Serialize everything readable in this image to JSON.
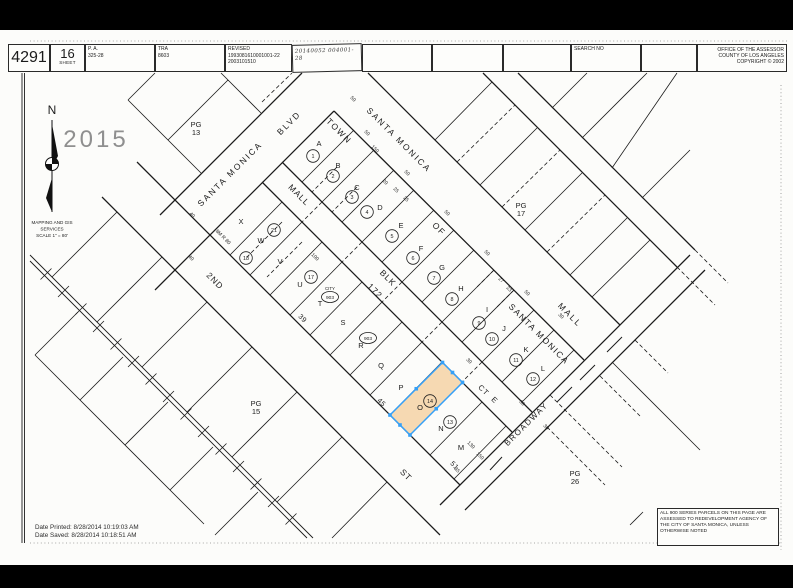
{
  "header": {
    "book": "4291",
    "sheet_number": "16",
    "sheet_label": "SHEET",
    "pa_label": "P. A.",
    "pa_value": "325-28",
    "tra_label": "TRA",
    "tra_value": "8603",
    "revised_label": "REVISED",
    "revised_line1": "1993081610001001-22",
    "revised_line2": "2003101510",
    "handwritten_note": "20140052 004001-28",
    "search_no_label": "SEARCH NO",
    "office_line1": "OFFICE OF THE ASSESSOR",
    "office_line2": "COUNTY OF LOS ANGELES",
    "office_line3": "COPYRIGHT © 2002"
  },
  "stamp_year": "2015",
  "compass": {
    "north_label": "N",
    "caption_lines": [
      "MAPPING AND GIS",
      "SERVICES",
      "SCALE 1\" = 80'"
    ]
  },
  "footer": {
    "date_printed": "Date Printed: 8/28/2014 10:19:03 AM",
    "date_saved": "Date Saved: 8/28/2014 10:18:51 AM"
  },
  "note_box": {
    "lines": [
      "ALL 900 SERIES PARCELS ON THIS PAGE ARE",
      "ASSESSED TO REDEVELOPMENT AGENCY OF THE",
      "CITY OF SANTA MONICA, UNLESS OTHERWISE",
      "NOTED"
    ]
  },
  "colors": {
    "highlight_fill": "#f6d9b2",
    "highlight_stroke": "#35a0f7",
    "stamp_gray": "#8f8f8f",
    "line_black": "#1c1c1c"
  },
  "map": {
    "street_labels": [
      {
        "t": "SANTA MONICA",
        "x": 232,
        "y": 176,
        "r": -45,
        "s": 8.5,
        "ls": 2,
        "name": "street-label-santa-monica-blvd-1"
      },
      {
        "t": "BLVD",
        "x": 291,
        "y": 125,
        "r": -45,
        "s": 8.5,
        "ls": 2,
        "name": "street-label-santa-monica-blvd-2"
      },
      {
        "t": "SANTA MONICA",
        "x": 397,
        "y": 142,
        "r": 45,
        "s": 8.5,
        "ls": 2,
        "name": "street-label-santa-monica-mall-1"
      },
      {
        "t": "MALL",
        "x": 568,
        "y": 317,
        "r": 45,
        "s": 8.5,
        "ls": 2,
        "name": "street-label-santa-monica-mall-2"
      },
      {
        "t": "MALL",
        "x": 297,
        "y": 197,
        "r": 45,
        "s": 8.5,
        "ls": 1,
        "name": "street-label-mall-corridor"
      },
      {
        "t": "TOWN",
        "x": 337,
        "y": 133,
        "r": 45,
        "s": 8.5,
        "ls": 1.5,
        "name": "tract-label-town"
      },
      {
        "t": "OF",
        "x": 437,
        "y": 231,
        "r": 45,
        "s": 8.5,
        "ls": 1.5,
        "name": "tract-label-of"
      },
      {
        "t": "SANTA MONICA",
        "x": 537,
        "y": 336,
        "r": 45,
        "s": 8.5,
        "ls": 1.5,
        "name": "tract-label-santa-monica"
      },
      {
        "t": "BLK",
        "x": 386,
        "y": 280,
        "r": 45,
        "s": 8.5,
        "ls": 1,
        "name": "tract-label-blk"
      },
      {
        "t": "172",
        "x": 373,
        "y": 293,
        "r": 45,
        "s": 8.5,
        "ls": 1,
        "name": "tract-label-172"
      },
      {
        "t": "2ND",
        "x": 213,
        "y": 283,
        "r": 45,
        "s": 8.5,
        "ls": 1,
        "name": "street-label-2nd"
      },
      {
        "t": "ST",
        "x": 404,
        "y": 477,
        "r": 45,
        "s": 8.5,
        "ls": 1,
        "name": "street-label-st"
      },
      {
        "t": "CT",
        "x": 482,
        "y": 392,
        "r": 45,
        "s": 7.5,
        "ls": 1,
        "name": "street-label-ct"
      },
      {
        "t": "E",
        "x": 493,
        "y": 402,
        "r": 45,
        "s": 7.5,
        "ls": 1,
        "name": "street-label-e"
      },
      {
        "t": "BROADWAY",
        "x": 528,
        "y": 426,
        "r": -45,
        "s": 8,
        "ls": 1.5,
        "name": "street-label-broadway"
      },
      {
        "t": "39",
        "x": 301,
        "y": 320,
        "r": 45,
        "s": 7,
        "ls": 0.5,
        "name": "frontage-number-39"
      },
      {
        "t": "45",
        "x": 380,
        "y": 404,
        "r": 45,
        "s": 7,
        "ls": 0.5,
        "name": "frontage-number-45"
      },
      {
        "t": "51",
        "x": 453,
        "y": 467,
        "r": 45,
        "s": 7,
        "ls": 0.5,
        "name": "frontage-number-51"
      }
    ],
    "page_refs": [
      {
        "a": "PG",
        "b": "13",
        "x": 196,
        "y": 124,
        "name": "page-ref-13"
      },
      {
        "a": "PG",
        "b": "17",
        "x": 521,
        "y": 205,
        "name": "page-ref-17"
      },
      {
        "a": "PG",
        "b": "15",
        "x": 256,
        "y": 403,
        "name": "page-ref-15"
      },
      {
        "a": "PG",
        "b": "26",
        "x": 575,
        "y": 473,
        "name": "page-ref-26"
      }
    ],
    "ne_parcels": [
      {
        "l": "A",
        "x": 319,
        "y": 146,
        "n": "1",
        "nx": 313,
        "ny": 156
      },
      {
        "l": "B",
        "x": 338,
        "y": 168,
        "n": "2",
        "nx": 333,
        "ny": 176
      },
      {
        "l": "C",
        "x": 357,
        "y": 190,
        "n": "3",
        "nx": 352,
        "ny": 197
      },
      {
        "l": "D",
        "x": 380,
        "y": 210,
        "n": "4",
        "nx": 367,
        "ny": 212
      },
      {
        "l": "E",
        "x": 401,
        "y": 228,
        "n": "5",
        "nx": 392,
        "ny": 236
      },
      {
        "l": "F",
        "x": 421,
        "y": 251,
        "n": "6",
        "nx": 413,
        "ny": 258
      },
      {
        "l": "G",
        "x": 442,
        "y": 270,
        "n": "7",
        "nx": 434,
        "ny": 278
      },
      {
        "l": "H",
        "x": 461,
        "y": 291,
        "n": "8",
        "nx": 452,
        "ny": 299
      },
      {
        "l": "I",
        "x": 487,
        "y": 312,
        "n": "9",
        "nx": 479,
        "ny": 323
      },
      {
        "l": "J",
        "x": 504,
        "y": 331,
        "n": "10",
        "nx": 492,
        "ny": 339
      },
      {
        "l": "K",
        "x": 526,
        "y": 352,
        "n": "11",
        "nx": 516,
        "ny": 360
      },
      {
        "l": "L",
        "x": 543,
        "y": 371,
        "n": "12",
        "nx": 533,
        "ny": 379
      }
    ],
    "sw_letters": [
      {
        "l": "X",
        "x": 241,
        "y": 224
      },
      {
        "l": "W",
        "x": 261,
        "y": 243
      },
      {
        "l": "V",
        "x": 280,
        "y": 264
      },
      {
        "l": "U",
        "x": 300,
        "y": 287
      },
      {
        "l": "T",
        "x": 320,
        "y": 306
      },
      {
        "l": "S",
        "x": 343,
        "y": 325
      },
      {
        "l": "R",
        "x": 361,
        "y": 348
      },
      {
        "l": "Q",
        "x": 381,
        "y": 368
      },
      {
        "l": "P",
        "x": 401,
        "y": 390
      },
      {
        "l": "O",
        "x": 420,
        "y": 410
      },
      {
        "l": "N",
        "x": 441,
        "y": 431
      },
      {
        "l": "M",
        "x": 461,
        "y": 450
      }
    ],
    "sw_circles": [
      {
        "n": "21",
        "x": 274,
        "y": 230
      },
      {
        "n": "18",
        "x": 246,
        "y": 258
      },
      {
        "n": "17",
        "x": 311,
        "y": 277
      },
      {
        "n": "903",
        "x": 330,
        "y": 297,
        "oval": true,
        "cap": "CITY"
      },
      {
        "n": "903",
        "x": 368,
        "y": 338,
        "oval": true
      },
      {
        "n": "14",
        "x": 430,
        "y": 401
      },
      {
        "n": "13",
        "x": 450,
        "y": 422
      }
    ],
    "dims": [
      {
        "t": "50",
        "x": 352,
        "y": 100
      },
      {
        "t": "50",
        "x": 366,
        "y": 134
      },
      {
        "t": "50",
        "x": 406,
        "y": 174
      },
      {
        "t": "50",
        "x": 446,
        "y": 214
      },
      {
        "t": "50",
        "x": 486,
        "y": 254
      },
      {
        "t": "50",
        "x": 526,
        "y": 294
      },
      {
        "t": "150",
        "x": 374,
        "y": 150
      },
      {
        "t": "20",
        "x": 384,
        "y": 183
      },
      {
        "t": "25",
        "x": 395,
        "y": 191
      },
      {
        "t": "25",
        "x": 405,
        "y": 200
      },
      {
        "t": "27",
        "x": 500,
        "y": 281
      },
      {
        "t": "23",
        "x": 508,
        "y": 290
      },
      {
        "t": "30",
        "x": 468,
        "y": 362
      },
      {
        "t": "30",
        "x": 560,
        "y": 317
      },
      {
        "t": "30",
        "x": 521,
        "y": 404
      },
      {
        "t": "30",
        "x": 545,
        "y": 428
      },
      {
        "t": "130",
        "x": 470,
        "y": 446
      },
      {
        "t": "150",
        "x": 479,
        "y": 457
      },
      {
        "t": "40",
        "x": 191,
        "y": 216
      },
      {
        "t": "40",
        "x": 190,
        "y": 259
      },
      {
        "t": "35",
        "x": 456,
        "y": 471
      },
      {
        "t": "100",
        "x": 314,
        "y": 258
      },
      {
        "t": "8M R 80",
        "x": 222,
        "y": 238
      }
    ],
    "highlight": {
      "parcel_letter": "O",
      "parcel_number": "14"
    }
  }
}
